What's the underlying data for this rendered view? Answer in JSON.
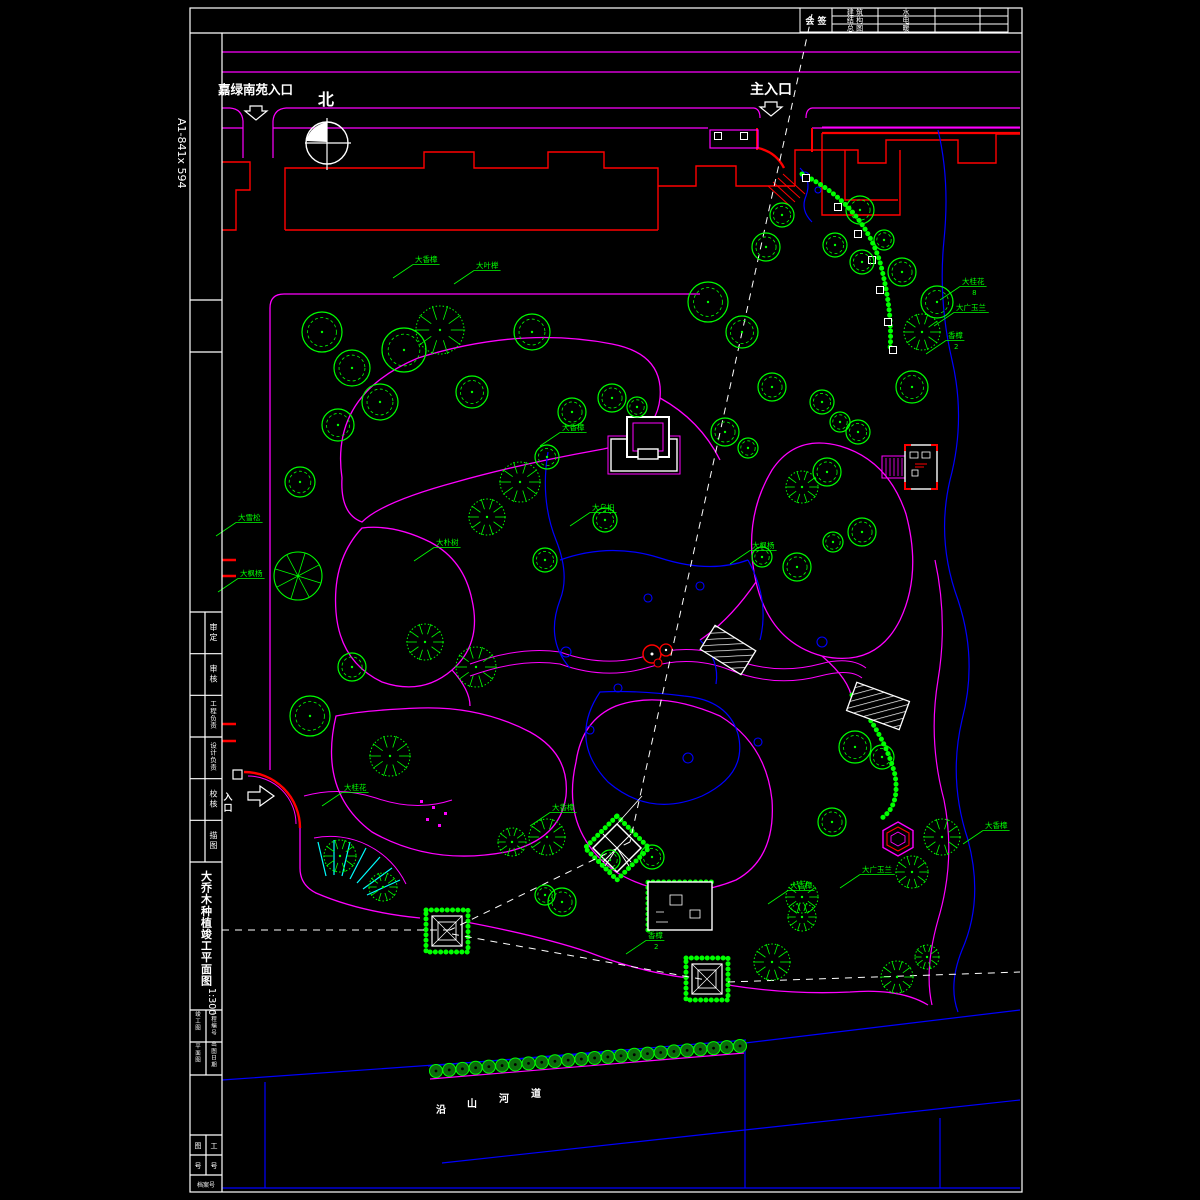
{
  "sheet": {
    "paper_size": "A1-841x 594"
  },
  "colors": {
    "path": "#ff00ff",
    "tree": "#00ff00",
    "water": "#0000ff",
    "building": "#ff0000",
    "line": "#ffffff",
    "steps": "#00ffff",
    "hedge_fill": "#0b6b0b"
  },
  "top_labels": {
    "north": "北",
    "main_entrance": "主入口",
    "side_entrance": "嘉绿南苑入口",
    "west_entrance_chars": [
      "入",
      "口"
    ]
  },
  "signature_block": {
    "label": "会 签",
    "rows": [
      {
        "discipline": "建 筑",
        "counter": "水"
      },
      {
        "discipline": "结 构",
        "counter": "电"
      },
      {
        "discipline": "总 图",
        "counter": "暖"
      }
    ]
  },
  "title_strip": {
    "rows": [
      "审 定",
      "审 核",
      "工程负责",
      "设计负责",
      "校 核",
      "描 图"
    ],
    "title": "大乔木种植竣工平面图",
    "scale": "1:300",
    "sub_cells": [
      "竣工图",
      "工程编号",
      "平面图",
      "出图日期"
    ],
    "bottom_left": "图号",
    "bottom_right": "工号",
    "bottom_span": "档案号"
  },
  "river_label": {
    "chars": [
      "沿",
      "山",
      "河",
      "道"
    ]
  },
  "plants": [
    {
      "name": "大香樟",
      "count": "",
      "x": 415,
      "y": 262
    },
    {
      "name": "大叶榉",
      "count": "",
      "x": 476,
      "y": 268
    },
    {
      "name": "大香樟",
      "count": "",
      "x": 562,
      "y": 430
    },
    {
      "name": "大乌桕",
      "count": "",
      "x": 592,
      "y": 510
    },
    {
      "name": "大朴树",
      "count": "",
      "x": 436,
      "y": 545
    },
    {
      "name": "大雪松",
      "count": "",
      "x": 238,
      "y": 520
    },
    {
      "name": "大枫杨",
      "count": "",
      "x": 240,
      "y": 576
    },
    {
      "name": "大桂花",
      "count": "",
      "x": 344,
      "y": 790
    },
    {
      "name": "大香樟",
      "count": "",
      "x": 552,
      "y": 810
    },
    {
      "name": "香樟",
      "count": "2",
      "x": 648,
      "y": 938
    },
    {
      "name": "大桂花",
      "count": "8",
      "x": 962,
      "y": 284
    },
    {
      "name": "大广玉兰",
      "count": "",
      "x": 956,
      "y": 310
    },
    {
      "name": "香樟",
      "count": "2",
      "x": 948,
      "y": 338
    },
    {
      "name": "大枫杨",
      "count": "",
      "x": 752,
      "y": 548
    },
    {
      "name": "大香樟",
      "count": "",
      "x": 985,
      "y": 828
    },
    {
      "name": "大广玉兰",
      "count": "",
      "x": 862,
      "y": 872
    },
    {
      "name": "大香樟",
      "count": "",
      "x": 790,
      "y": 888
    }
  ],
  "trees": [
    [
      322,
      332,
      20,
      "l"
    ],
    [
      352,
      368,
      18,
      "l"
    ],
    [
      404,
      350,
      22,
      "l"
    ],
    [
      380,
      402,
      18,
      "l"
    ],
    [
      338,
      425,
      16,
      "l"
    ],
    [
      300,
      482,
      15,
      "l"
    ],
    [
      298,
      576,
      24,
      "s"
    ],
    [
      310,
      716,
      20,
      "l"
    ],
    [
      352,
      667,
      14,
      "l"
    ],
    [
      390,
      756,
      20,
      "f"
    ],
    [
      425,
      642,
      18,
      "f"
    ],
    [
      476,
      667,
      20,
      "f"
    ],
    [
      340,
      856,
      16,
      "f"
    ],
    [
      383,
      887,
      14,
      "f"
    ],
    [
      440,
      330,
      24,
      "f"
    ],
    [
      532,
      332,
      18,
      "l"
    ],
    [
      472,
      392,
      16,
      "l"
    ],
    [
      520,
      482,
      20,
      "f"
    ],
    [
      487,
      517,
      18,
      "f"
    ],
    [
      572,
      412,
      14,
      "l"
    ],
    [
      547,
      457,
      12,
      "l"
    ],
    [
      612,
      398,
      14,
      "l"
    ],
    [
      637,
      407,
      10,
      "l"
    ],
    [
      545,
      560,
      12,
      "l"
    ],
    [
      605,
      520,
      12,
      "l"
    ],
    [
      708,
      302,
      20,
      "l"
    ],
    [
      742,
      332,
      16,
      "l"
    ],
    [
      766,
      247,
      14,
      "l"
    ],
    [
      782,
      215,
      12,
      "l"
    ],
    [
      772,
      387,
      14,
      "l"
    ],
    [
      725,
      432,
      14,
      "l"
    ],
    [
      748,
      448,
      10,
      "l"
    ],
    [
      822,
      402,
      12,
      "l"
    ],
    [
      840,
      422,
      10,
      "l"
    ],
    [
      858,
      432,
      12,
      "l"
    ],
    [
      827,
      472,
      14,
      "l"
    ],
    [
      802,
      487,
      16,
      "f"
    ],
    [
      862,
      532,
      14,
      "l"
    ],
    [
      833,
      542,
      10,
      "l"
    ],
    [
      912,
      387,
      16,
      "l"
    ],
    [
      922,
      332,
      18,
      "f"
    ],
    [
      937,
      302,
      16,
      "l"
    ],
    [
      902,
      272,
      14,
      "l"
    ],
    [
      862,
      262,
      12,
      "l"
    ],
    [
      884,
      240,
      10,
      "l"
    ],
    [
      860,
      210,
      14,
      "l"
    ],
    [
      835,
      245,
      12,
      "l"
    ],
    [
      797,
      567,
      14,
      "l"
    ],
    [
      762,
      557,
      10,
      "l"
    ],
    [
      855,
      747,
      16,
      "l"
    ],
    [
      882,
      757,
      12,
      "l"
    ],
    [
      942,
      837,
      18,
      "f"
    ],
    [
      912,
      872,
      16,
      "f"
    ],
    [
      832,
      822,
      14,
      "l"
    ],
    [
      802,
      897,
      16,
      "f"
    ],
    [
      547,
      837,
      18,
      "f"
    ],
    [
      512,
      842,
      14,
      "f"
    ],
    [
      562,
      902,
      14,
      "l"
    ],
    [
      652,
      857,
      12,
      "l"
    ],
    [
      772,
      962,
      18,
      "f"
    ],
    [
      802,
      917,
      14,
      "f"
    ],
    [
      897,
      977,
      16,
      "f"
    ],
    [
      927,
      957,
      12,
      "f"
    ],
    [
      545,
      895,
      10,
      "l"
    ],
    [
      610,
      860,
      10,
      "l"
    ]
  ],
  "stones": [
    [
      806,
      178
    ],
    [
      838,
      207
    ],
    [
      858,
      234
    ],
    [
      872,
      260
    ],
    [
      880,
      290
    ],
    [
      888,
      322
    ],
    [
      893,
      350
    ],
    [
      718,
      136
    ],
    [
      744,
      136
    ]
  ]
}
